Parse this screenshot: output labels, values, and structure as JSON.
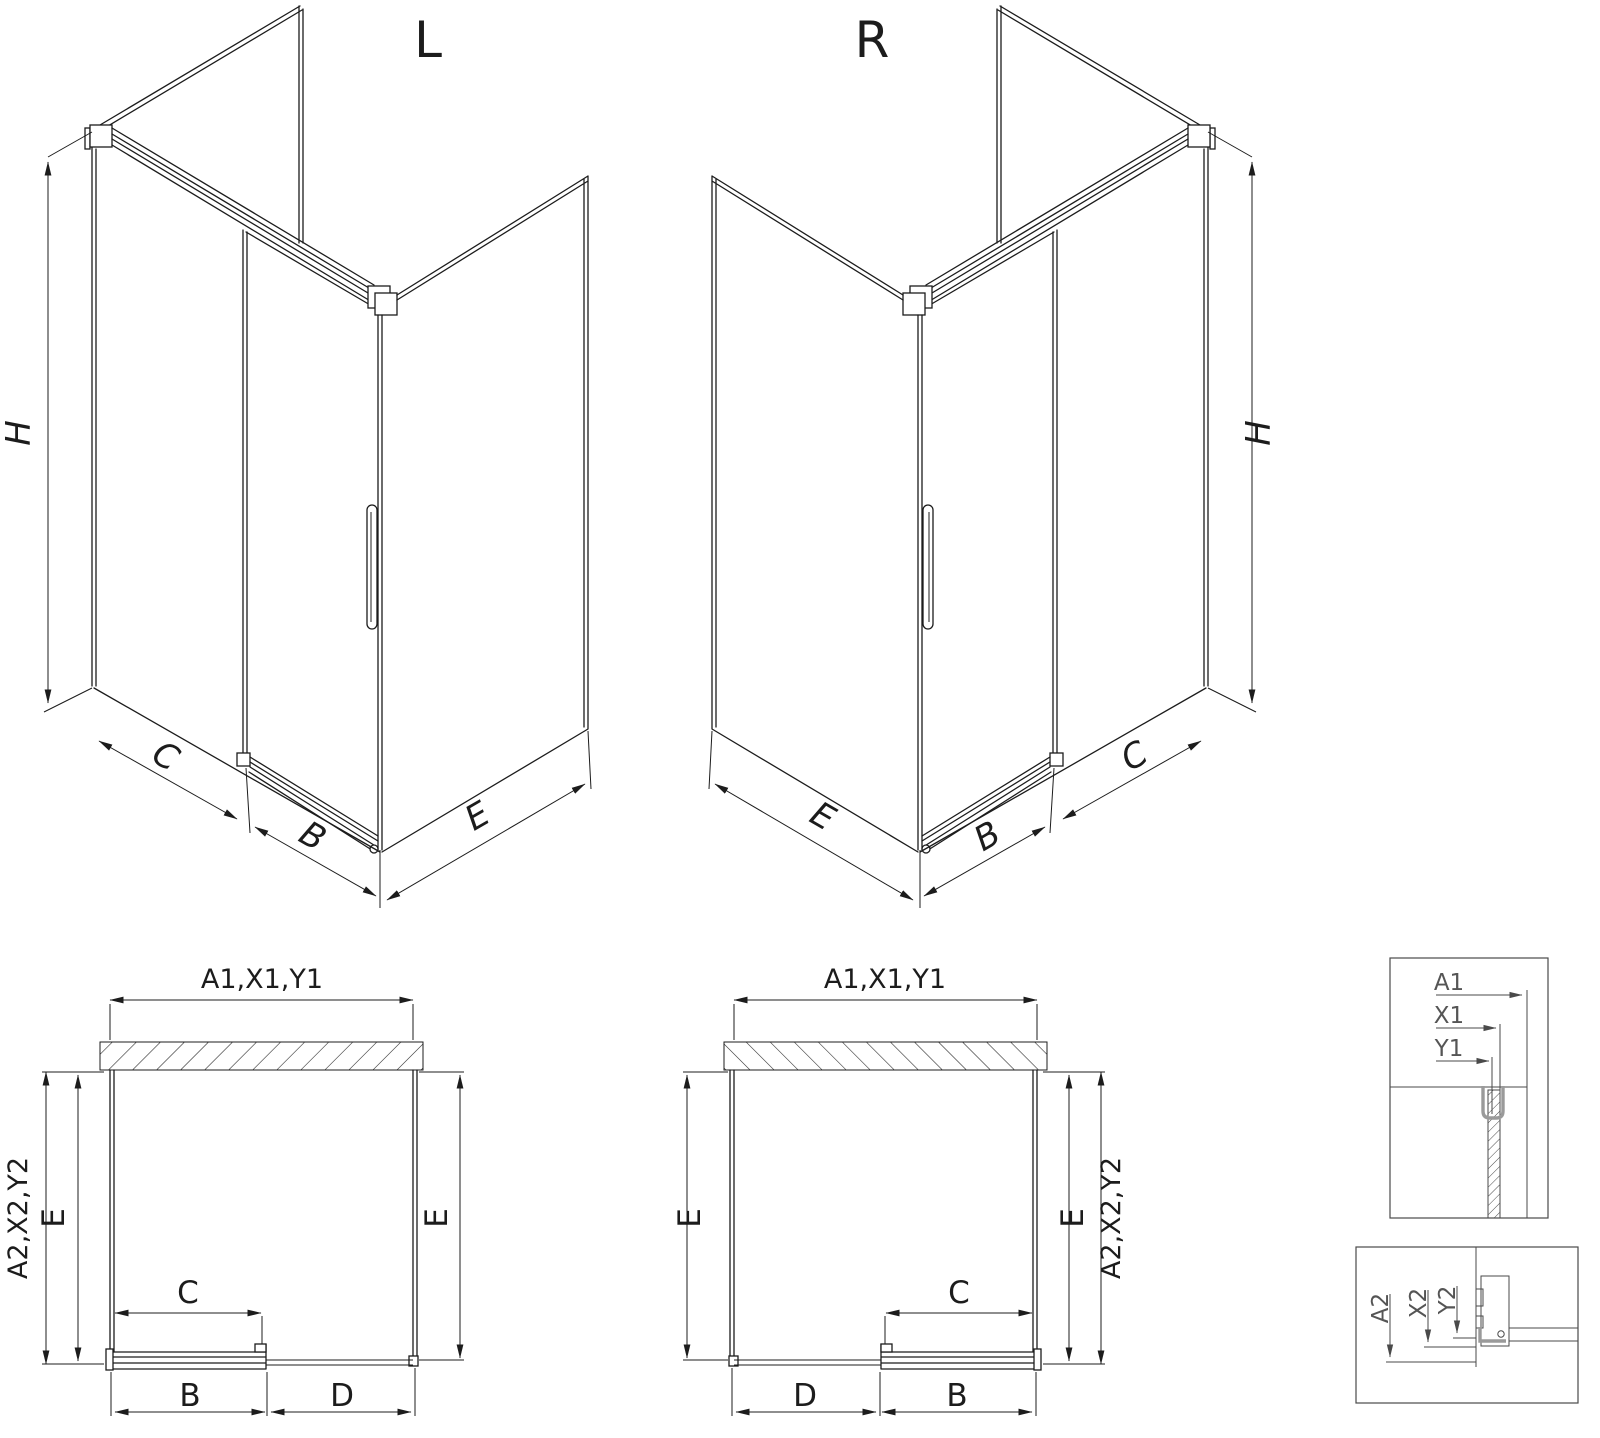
{
  "drawing": {
    "background": "#ffffff",
    "line_color": "#1c1c1c",
    "accent_gray": "#9a9a9a",
    "views": {
      "iso_left": {
        "title": "L",
        "height": "H",
        "segment_open": "C",
        "segment_door": "B",
        "side_panel": "E"
      },
      "iso_right": {
        "title": "R",
        "height": "H",
        "segment_open": "C",
        "segment_door": "B",
        "side_panel": "E"
      },
      "plan_left": {
        "width_top": "A1,X1,Y1",
        "depth_outer": "A2,X2,Y2",
        "side_left": "E",
        "side_right": "E",
        "slide": "C",
        "door": "B",
        "fixed": "D"
      },
      "plan_right": {
        "width_top": "A1,X1,Y1",
        "depth_outer": "A2,X2,Y2",
        "side_left": "E",
        "side_right": "E",
        "slide": "C",
        "door": "B",
        "fixed": "D"
      },
      "detail_wall": {
        "labels": [
          "A1",
          "X1",
          "Y1"
        ]
      },
      "detail_floor": {
        "labels": [
          "A2",
          "X2",
          "Y2"
        ]
      }
    }
  }
}
